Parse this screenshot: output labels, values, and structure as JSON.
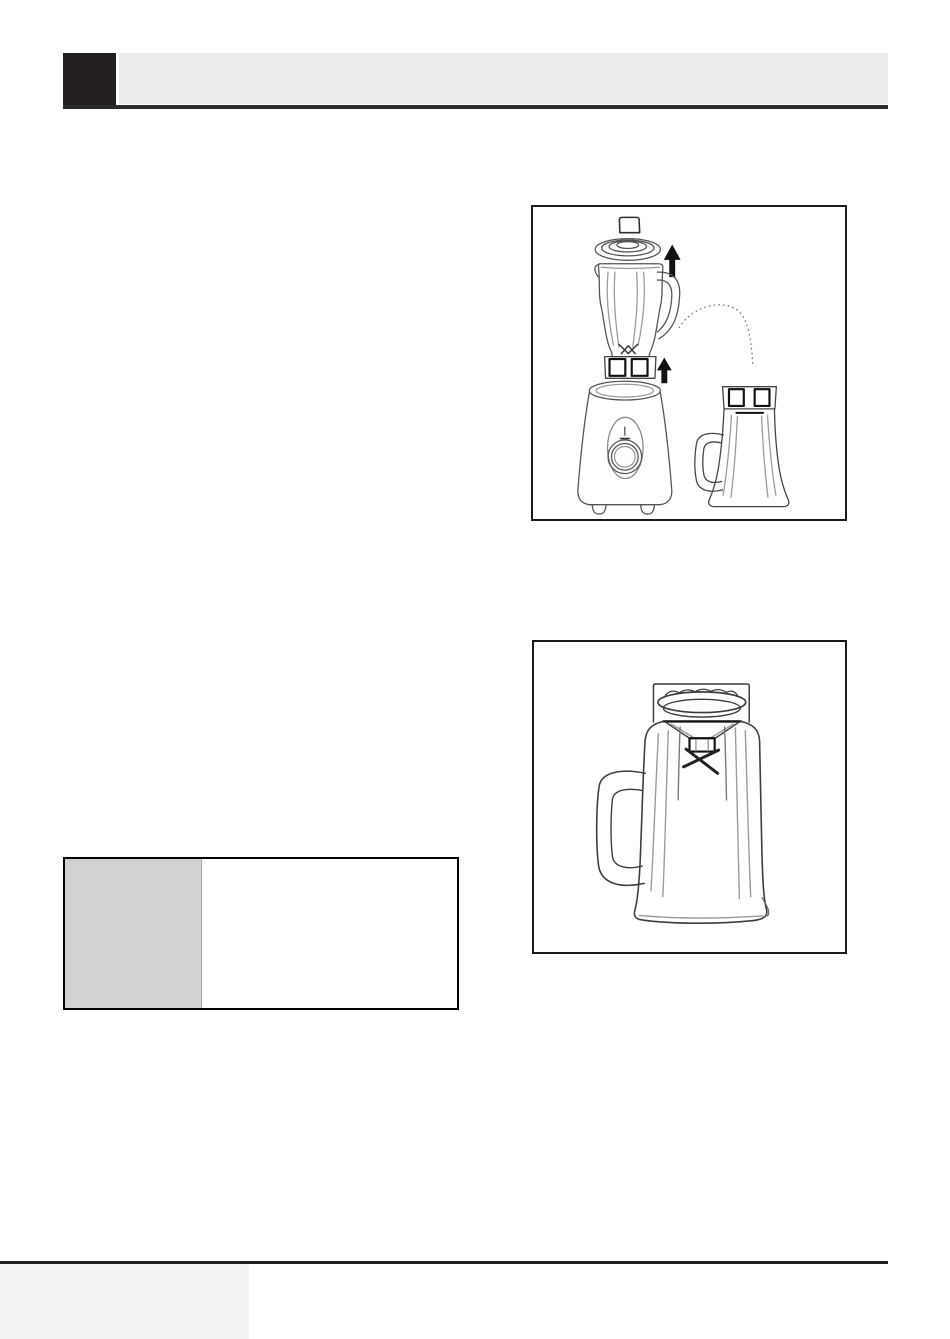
{
  "page": {
    "kind": "appliance-instruction-manual-page",
    "colors": {
      "page-bg": "#ffffff",
      "header-block": "#231f20",
      "header-bar": "#ececec",
      "header-rule": "#2d2a2b",
      "figure-border": "#1a1a1a",
      "table-border": "#000000",
      "table-label-bg": "#d2d2d2",
      "table-divider": "#a8a8a8",
      "footer-rule": "#1f1f1f",
      "footer-block": "#f3f3f3",
      "art-line": "#4a4a4a",
      "art-line-light": "#9b9b9b",
      "art-dark": "#111111"
    }
  },
  "figures": [
    {
      "name": "blender-jar-removal-and-chopper-attachment-illustration"
    },
    {
      "name": "chopper-jar-with-blade-assembly-illustration"
    }
  ],
  "table": {
    "label_column_present": "true"
  }
}
